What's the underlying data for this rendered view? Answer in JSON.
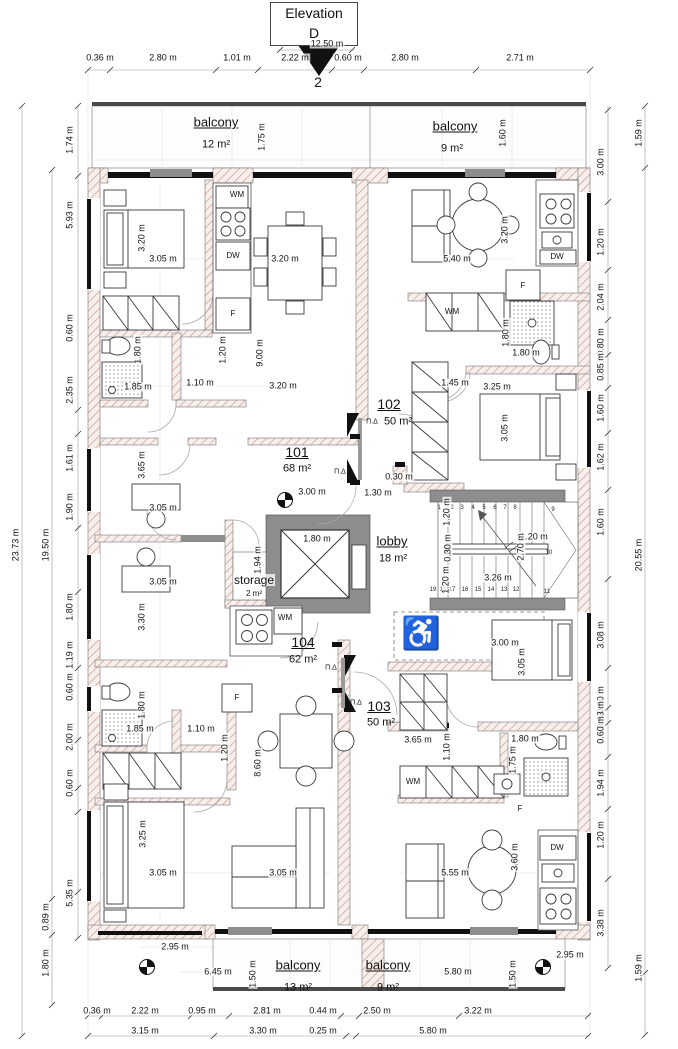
{
  "drawing": {
    "elevation_marker": {
      "line1": "Elevation",
      "line2": "D",
      "number": "2",
      "width_dim": "12.50 m"
    }
  },
  "units": {
    "u101": {
      "number": "101",
      "area": "68 m²"
    },
    "u102": {
      "number": "102",
      "area": "50 m²"
    },
    "u103": {
      "number": "103",
      "area": "50 m²"
    },
    "u104": {
      "number": "104",
      "area": "62 m²"
    }
  },
  "rooms": {
    "lobby": {
      "name": "lobby",
      "area": "18 m²"
    },
    "storage": {
      "name": "storage",
      "area": "2 m²"
    },
    "balcony_top_left": {
      "name": "balcony",
      "area": "12 m²"
    },
    "balcony_top_right": {
      "name": "balcony",
      "area": "9 m²"
    },
    "balcony_bottom_left": {
      "name": "balcony",
      "area": "13 m²"
    },
    "balcony_bottom_right": {
      "name": "balcony",
      "area": "9 m²"
    }
  },
  "appliances": {
    "washing_machine": "WM",
    "fridge": "F",
    "dishwasher": "DW"
  },
  "door_marker": "Π.Δ",
  "accessible_icon": "♿",
  "stair_steps": [
    "1",
    "2",
    "3",
    "4",
    "5",
    "6",
    "7",
    "8",
    "9",
    "10",
    "11",
    "12",
    "13",
    "14",
    "15",
    "16",
    "17",
    "18",
    "19"
  ],
  "dimensions": {
    "top_row": [
      "0.36 m",
      "2.80 m",
      "1.01 m",
      "2.22 m",
      "0.60 m",
      "2.80 m",
      "2.71 m"
    ],
    "bottom_row_1": [
      "0.36 m",
      "2.22 m",
      "0.95 m",
      "2.81 m",
      "0.44 m",
      "2.50 m",
      "3.22 m"
    ],
    "bottom_row_2": [
      "3.15 m",
      "3.30 m",
      "0.25 m",
      "5.80 m"
    ],
    "left_outer": "23.73 m",
    "left_mid": [
      "19.50 m",
      "0.89 m",
      "1.80 m"
    ],
    "left_inner": [
      "1.74 m",
      "5.93 m",
      "0.60 m",
      "2.35 m",
      "1.61 m",
      "1.90 m",
      "1.80 m",
      "1.19 m",
      "0.60 m",
      "2.00 m",
      "0.60 m",
      "5.35 m"
    ],
    "right_outer": [
      "1.59 m",
      "20.55 m",
      "1.59 m"
    ],
    "right_inner": [
      "3.00 m",
      "1.20 m",
      "2.04 m",
      "0.80 m",
      "0.85 m",
      "1.60 m",
      "1.62 m",
      "1.60 m",
      "3.08 m",
      "0.60 m",
      "0.33 m",
      "0.60 m",
      "1.94 m",
      "1.20 m",
      "3.38 m"
    ],
    "interior": [
      "3.20 m",
      "3.05 m",
      "3.20 m",
      "1.80 m",
      "1.20 m",
      "9.00 m",
      "1.85 m",
      "1.10 m",
      "3.20 m",
      "5.40 m",
      "3.20 m",
      "1.80 m",
      "1.80 m",
      "1.45 m",
      "3.25 m",
      "3.05 m",
      "3.65 m",
      "3.05 m",
      "3.00 m",
      "0.30 m",
      "1.30 m",
      "3.05 m",
      "3.30 m",
      "1.80 m",
      "1.94 m",
      "1.20 m",
      "0.30 m",
      "1.20 m",
      "1.20 m",
      "2.70 m",
      "3.26 m",
      "3.00 m",
      "3.05 m",
      "1.80 m",
      "1.85 m",
      "1.10 m",
      "1.20 m",
      "8.60 m",
      "3.25 m",
      "3.05 m",
      "3.05 m",
      "3.65 m",
      "1.10 m",
      "1.80 m",
      "1.75 m",
      "5.55 m",
      "3.60 m",
      "1.75 m",
      "1.60 m",
      "2.95 m",
      "6.45 m",
      "1.50 m",
      "5.80 m",
      "1.50 m",
      "2.95 m"
    ]
  }
}
